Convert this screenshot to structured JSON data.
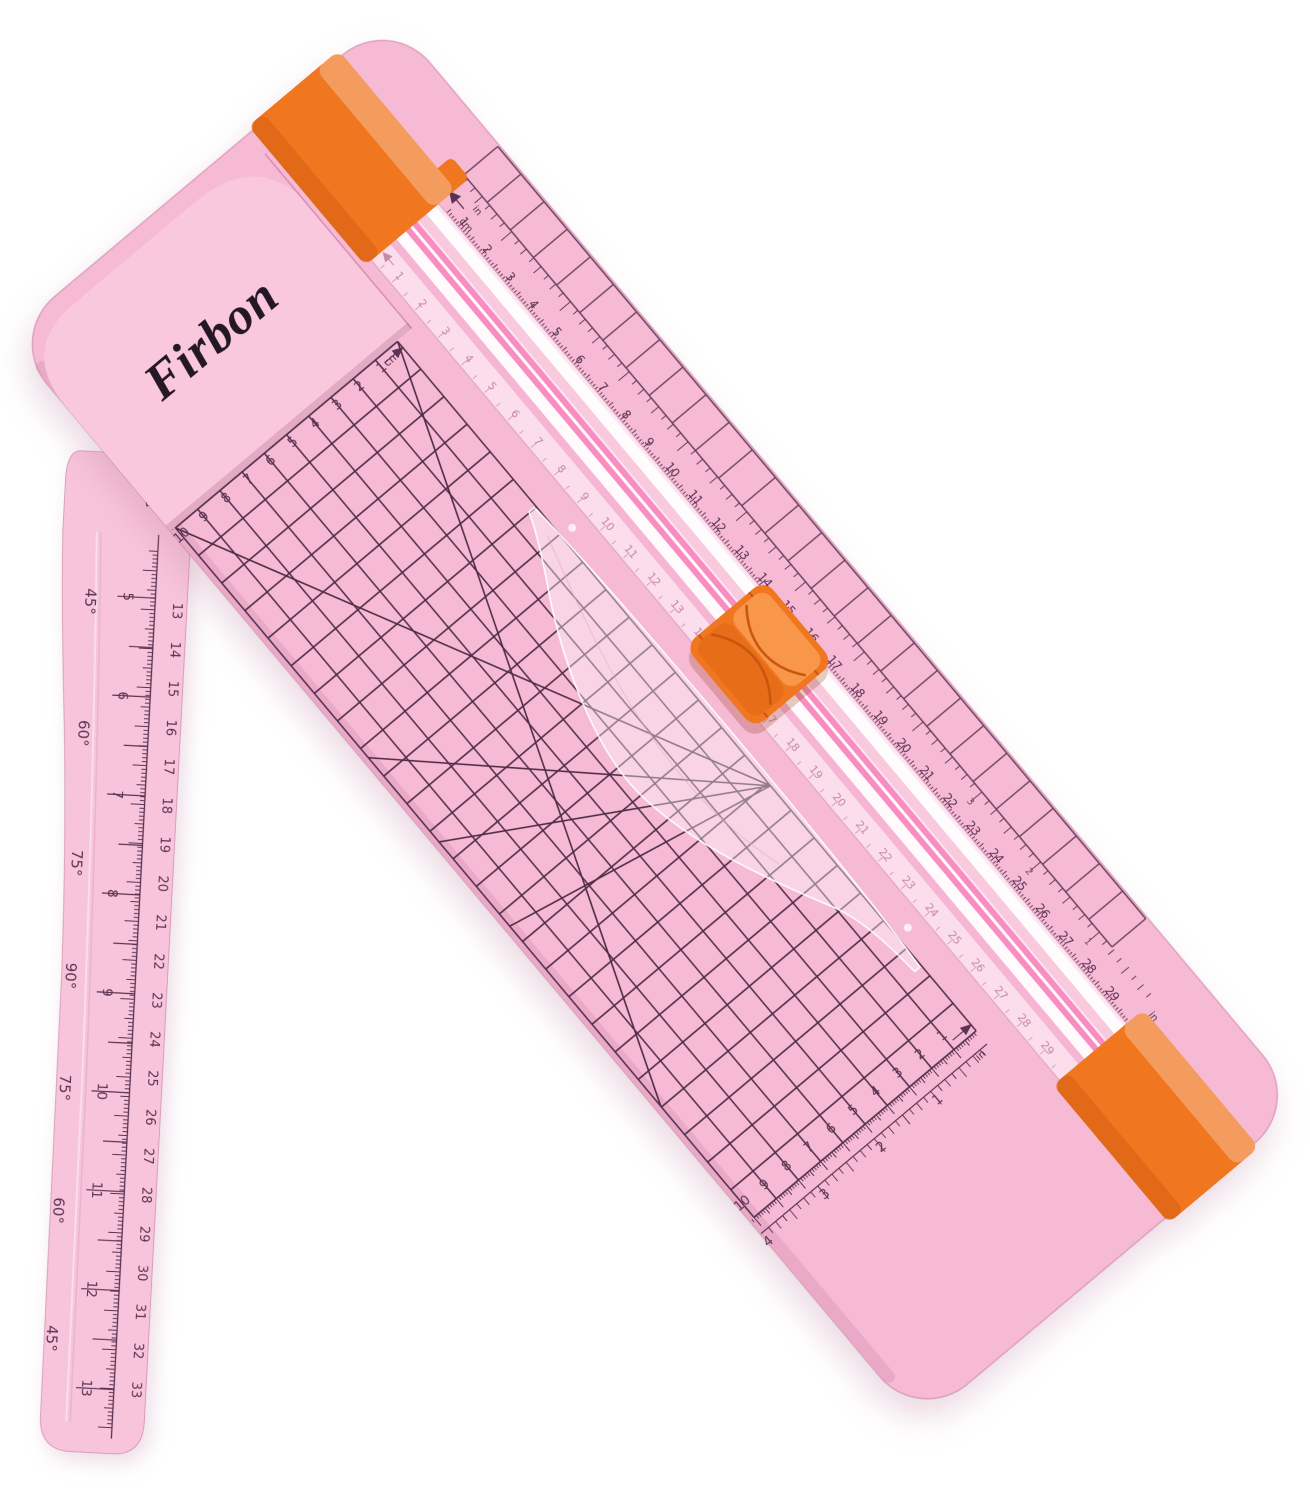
{
  "brand": {
    "name": "Firbon"
  },
  "product": {
    "type": "paper-trimmer",
    "body_style": "A5 portable trimmer with swing-out arm"
  },
  "colors": {
    "background": "#ffffff",
    "body_pink": "#f6bad4",
    "head_pink": "#f9c8dd",
    "arm_pink": "#f8c4db",
    "accent_orange": "#f0761f",
    "orange_highlight": "#f89a4f",
    "orange_dark": "#d65f10",
    "rail_translucent": "#fce8f2",
    "rail_stripe_pink": "#f87cb5",
    "grid_line": "#4e2b47",
    "ruler_text_dark": "#5a3252",
    "ruler_text_faded": "#c489a8"
  },
  "grid": {
    "columns": 25,
    "rows": 10,
    "edge_square_cells": 28
  },
  "head_ruler": {
    "cm_numbers": [
      1,
      2,
      3,
      4,
      5,
      6,
      7,
      8,
      9,
      10
    ],
    "inch_numbers": [
      1,
      2,
      3,
      4
    ],
    "label_in": "in",
    "label_cm": "cm"
  },
  "far_ruler": {
    "cm_numbers": [
      1,
      2,
      3,
      4,
      5,
      6,
      7,
      8,
      9,
      10
    ],
    "inch_numbers": [
      1,
      2,
      3,
      4
    ],
    "label_in": "in"
  },
  "rail_outer_ruler": {
    "cm_numbers": [
      1,
      2,
      3,
      4,
      5,
      6,
      7,
      8,
      9,
      10,
      11,
      12,
      13,
      14,
      15,
      16,
      17,
      18,
      19,
      20,
      21,
      22,
      23,
      24,
      25,
      26,
      27,
      28,
      29,
      30,
      31
    ],
    "reverse_inch_numbers": [
      1,
      2,
      3
    ],
    "label_in_start": "in",
    "label_cm_start": "cm",
    "label_in_end": "in",
    "label_cm_end": "cm"
  },
  "rail_inner_ruler": {
    "cm_numbers": [
      1,
      2,
      3,
      4,
      5,
      6,
      7,
      8,
      9,
      10,
      11,
      12,
      13,
      14,
      15,
      16,
      17,
      18,
      19,
      20,
      21,
      22,
      23,
      24,
      25,
      26,
      27,
      28,
      29,
      30,
      31
    ]
  },
  "arm": {
    "angle_labels": [
      "45°",
      "60°",
      "75°",
      "90°",
      "75°",
      "60°",
      "45°"
    ],
    "cm_numbers": [
      13,
      14,
      15,
      16,
      17,
      18,
      19,
      20,
      21,
      22,
      23,
      24,
      25,
      26,
      27,
      28,
      29,
      30,
      31,
      32,
      33
    ],
    "inch_numbers": [
      5,
      6,
      7,
      8,
      9,
      10,
      11,
      12,
      13
    ]
  }
}
